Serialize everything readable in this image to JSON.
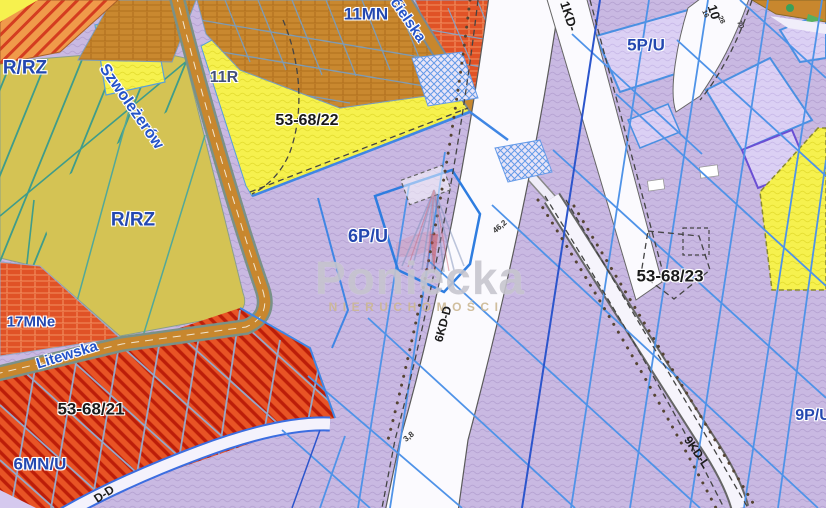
{
  "map": {
    "watermark": {
      "name": "Poniecka",
      "subtitle": "NIERUCHOMOŚCI"
    },
    "zone_labels": {
      "rrz_top": "R/RZ",
      "rrz_mid": "R/RZ",
      "mn11": "11MN",
      "r11": "11R",
      "pu5": "5P/U",
      "pu6": "6P/U",
      "mne17": "17MNe",
      "mnu6": "6MN/U",
      "pu9": "9P/U"
    },
    "parcel_numbers": {
      "p22": "53-68/22",
      "p21": "53-68/21",
      "p23": "53-68/23"
    },
    "street_names": {
      "szwolezerow": "Szwoleżerów",
      "cielska": "ćielska",
      "litewska": "Litewska"
    },
    "road_codes": {
      "kd1": "1KD-",
      "kd10": "10",
      "kd6": "6KD-D",
      "kd9": "9KD-L",
      "kdd": "D-D"
    },
    "measurements": {
      "m462": "46,2",
      "m38": "3,8",
      "m16": "16",
      "m28": "28",
      "m70": "70"
    },
    "colors": {
      "purple_zone": "#c9b9e2",
      "light_purple_zone": "#dbd0f4",
      "yellow_zone": "#f6f14e",
      "khaki_farmland": "#d4c354",
      "orange_housing": "#c9882f",
      "red_housing": "#e85425",
      "road_tan": "#c8872e",
      "road_white": "#f8f6fd",
      "parcel_line_blue": "#4f93e8",
      "teal_line": "#3f9c8a",
      "label_blue": "#2448b0"
    }
  }
}
